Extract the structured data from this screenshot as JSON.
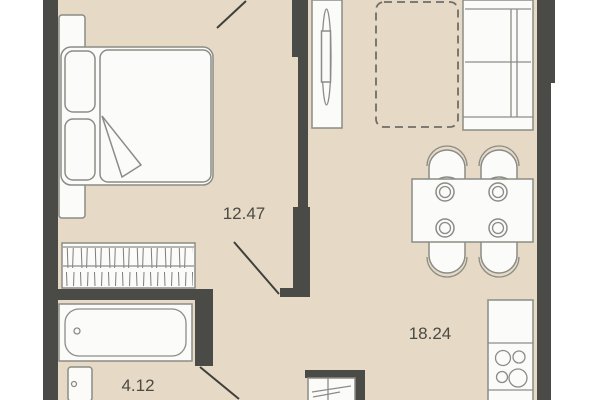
{
  "plan": {
    "title": "apartment-floor-plan",
    "rooms": [
      {
        "id": "bedroom",
        "area_label": "12.47"
      },
      {
        "id": "living-kitchen",
        "area_label": "18.24"
      },
      {
        "id": "bathroom",
        "area_label": "4.12"
      }
    ],
    "colors": {
      "floor": "#e6d9c6",
      "wall": "#4a4a47",
      "furniture_fill": "#fbfbfa",
      "furniture_stroke": "#8c8c86",
      "door_line": "#3f3f3c",
      "dashed": "#6e6e68",
      "label_text": "#4b4a43",
      "exterior": "#ffffff"
    }
  }
}
